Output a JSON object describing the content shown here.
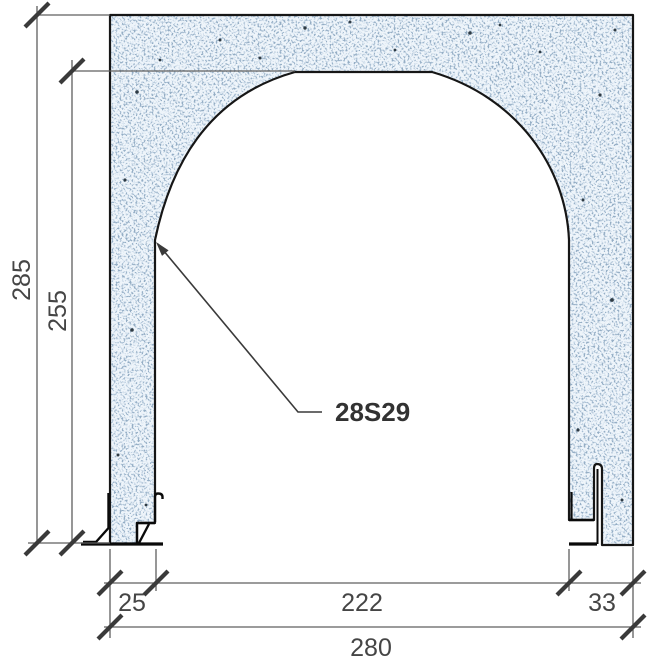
{
  "diagram": {
    "callout": {
      "label": "28S29"
    },
    "dimensions": {
      "overall_height": "285",
      "opening_height": "255",
      "left_jamb_width": "25",
      "opening_width": "222",
      "right_jamb_width": "33",
      "overall_width": "280"
    },
    "colors": {
      "concrete_fill": "#dde9f4",
      "concrete_speckle": "#9fbcd6",
      "concrete_dark_speckle": "#54748f",
      "outline": "#161616",
      "dimension_line": "#5f5f5f",
      "tick_and_text": "#3f3f3f"
    }
  }
}
